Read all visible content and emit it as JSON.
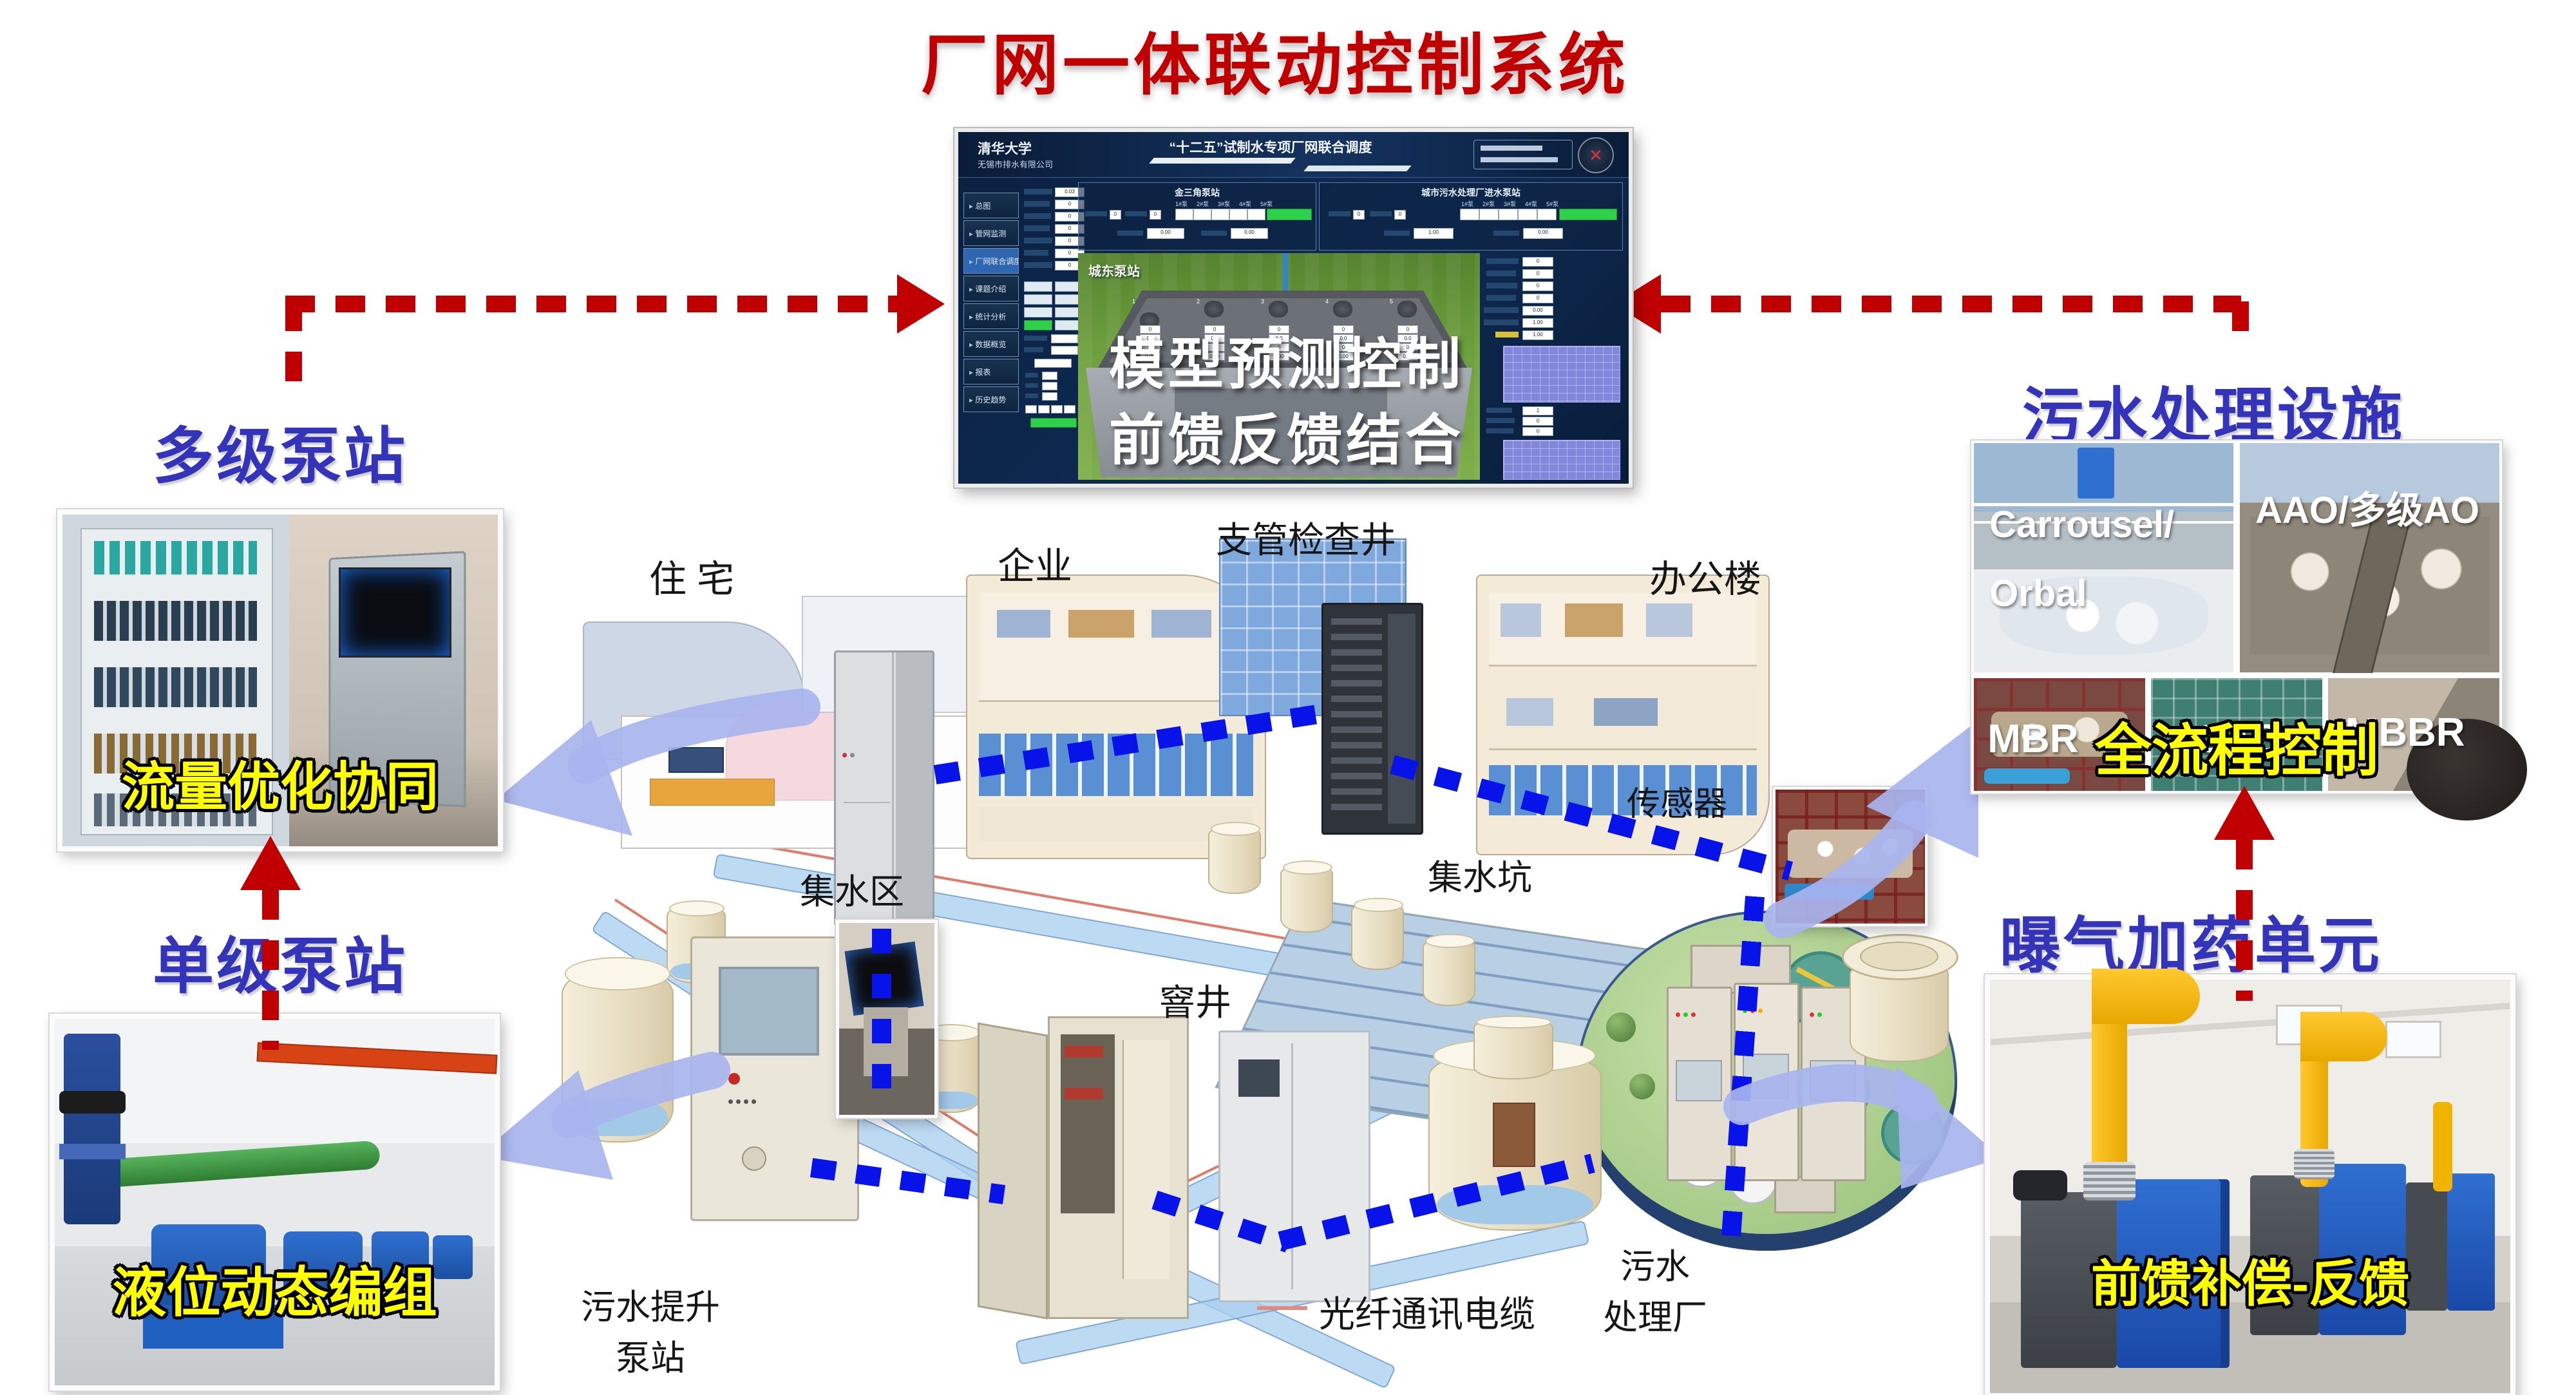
{
  "title": "厂网一体联动控制系统",
  "colors": {
    "accent_red": "#c00000",
    "accent_blue": "#3434bb",
    "caption_yellow": "#ffff00",
    "comm_line_blue": "#0713e8"
  },
  "scada": {
    "org_line1": "清华大学",
    "org_line2": "无锡市排水有限公司",
    "banner": "“十二五”试制水专项厂网联合调度",
    "close_icon": "✕",
    "menu": [
      "总图",
      "管网监测",
      "厂网联合调度",
      "课题介绍",
      "统计分析",
      "数据概览",
      "报表",
      "历史趋势"
    ],
    "panel_left_title": "金三角泵站",
    "panel_right_title": "城市污水处理厂进水泵站",
    "pump_unit_headers": [
      "1#泵",
      "2#泵",
      "3#泵",
      "4#泵",
      "5#泵"
    ],
    "panel_left_vals": {
      "a": "0",
      "b": "0",
      "c": "0.00",
      "d": "0.00"
    },
    "panel_right_vals": {
      "a": "0",
      "b": "0",
      "c": "1.00",
      "d": "0.00"
    },
    "map_label": "城东泵站",
    "pump_numbers": [
      "1",
      "2",
      "3",
      "4",
      "5"
    ],
    "pump_box_values": [
      "0",
      "0.0",
      "0",
      "0.00"
    ],
    "left_col_values": [
      "0.03",
      "0",
      "0",
      "0",
      "0",
      "0",
      "0"
    ],
    "right_col_values": [
      "0",
      "0",
      "0",
      "0",
      "0.00",
      "1.00",
      "1.00"
    ],
    "right_mid_values": [
      "1",
      "0",
      "0",
      "0"
    ],
    "overlay_line1": "模型预测控制",
    "overlay_line2": "前馈反馈结合"
  },
  "sections": {
    "multi_pump": {
      "title": "多级泵站",
      "caption": "流量优化协同"
    },
    "single_pump": {
      "title": "单级泵站",
      "caption": "液位动态编组"
    },
    "treatment": {
      "title": "污水处理设施",
      "caption": "全流程控制",
      "photo_labels": [
        "Carrousel/",
        "Orbal",
        "AAO/多级AO",
        "MBR",
        "CAS",
        "MBBR"
      ]
    },
    "aeration": {
      "title": "曝气加药单元",
      "caption": "前馈补偿-反馈"
    }
  },
  "map_labels": {
    "residential": "住 宅",
    "enterprise": "企业",
    "branch_manhole": "支管检查井",
    "office": "办公楼",
    "sensor": "传感器",
    "sump_pit": "集水坑",
    "catchment": "集水区",
    "manhole": "窨井",
    "lift_station_line1": "污水提升",
    "lift_station_line2": "泵站",
    "fiber_cable": "光纤通讯电缆",
    "wwtp_line1": "污水",
    "wwtp_line2": "处理厂"
  }
}
